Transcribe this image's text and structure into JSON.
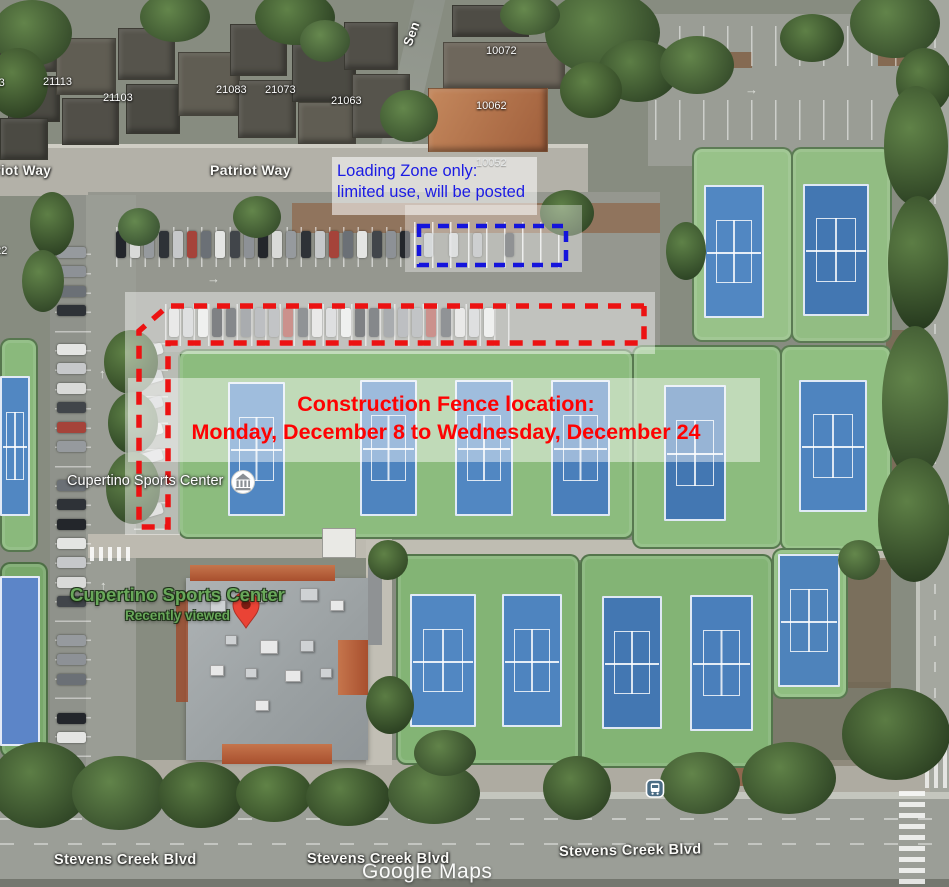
{
  "map": {
    "attribution": "Google Maps",
    "streets": [
      {
        "text": "Patriot Way",
        "x": -27,
        "y": 163,
        "size": 13.5,
        "rot": 0
      },
      {
        "text": "Patriot Way",
        "x": 210,
        "y": 162,
        "size": 14,
        "rot": 0
      },
      {
        "text": "Sen",
        "x": 407,
        "y": 38,
        "size": 13,
        "rot": -70
      },
      {
        "text": "Stevens Creek Blvd",
        "x": 54,
        "y": 852,
        "size": 14.5,
        "rot": 0
      },
      {
        "text": "Stevens Creek Blvd",
        "x": 307,
        "y": 851,
        "size": 14.5,
        "rot": 0
      },
      {
        "text": "Stevens Creek Blvd",
        "x": 559,
        "y": 844,
        "size": 14.5,
        "rot": -1
      }
    ],
    "house_numbers": [
      {
        "text": "21123",
        "x": -25,
        "y": 77
      },
      {
        "text": "21113",
        "x": 43,
        "y": 76
      },
      {
        "text": "21103",
        "x": 103,
        "y": 92
      },
      {
        "text": "21083",
        "x": 216,
        "y": 84
      },
      {
        "text": "21073",
        "x": 265,
        "y": 84
      },
      {
        "text": "21063",
        "x": 331,
        "y": 95
      },
      {
        "text": "10072",
        "x": 486,
        "y": 45
      },
      {
        "text": "10062",
        "x": 476,
        "y": 100
      },
      {
        "text": "10052",
        "x": 476,
        "y": 157,
        "faint": true
      },
      {
        "text": "122",
        "x": -11,
        "y": 245
      }
    ],
    "poi_label": {
      "text": "Cupertino Sports Center"
    },
    "place": {
      "name": "Cupertino Sports Center",
      "status": "Recently viewed"
    }
  },
  "annotations": {
    "loading_zone": {
      "line1": "Loading Zone only:",
      "line2": "limited use, will be posted",
      "color": "#1b1be4"
    },
    "construction": {
      "line1": "Construction Fence location:",
      "line2": "Monday, December 8 to Wednesday, December 24",
      "color": "#fe0202"
    },
    "fence_outline_color": "#ec1212",
    "loading_zone_outline_color": "#1414dc"
  },
  "icons": {
    "pin": "red-map-pin",
    "poi": "sports-center-poi-badge",
    "bus": "bus-stop-icon"
  }
}
